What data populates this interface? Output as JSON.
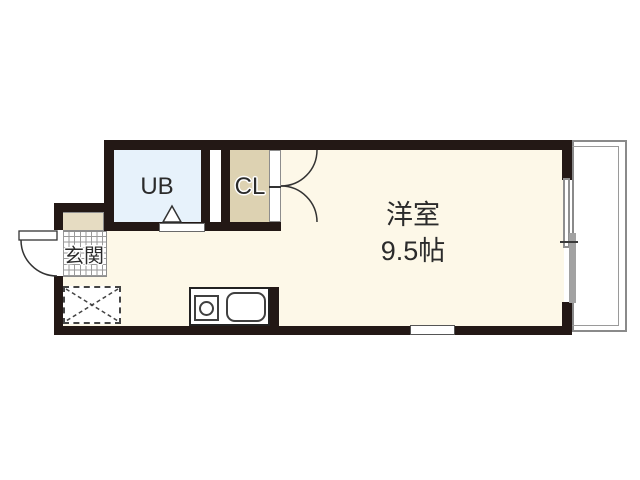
{
  "plan": {
    "rooms": {
      "unit_bath": {
        "label": "UB"
      },
      "closet": {
        "label": "CL"
      },
      "entrance": {
        "label": "玄関"
      },
      "main_room": {
        "name": "洋室",
        "size": "9.5帖"
      }
    },
    "colors": {
      "wall": "#231815",
      "main_room_floor": "#fdf8e8",
      "unit_bath_floor": "#e7f2fb",
      "closet_floor": "#ddd2b2",
      "cabinet_floor": "#e6dcc2",
      "balcony_line": "#8a8a8a",
      "fixture_line": "#404040",
      "label_text": "#2b2b2b"
    }
  }
}
